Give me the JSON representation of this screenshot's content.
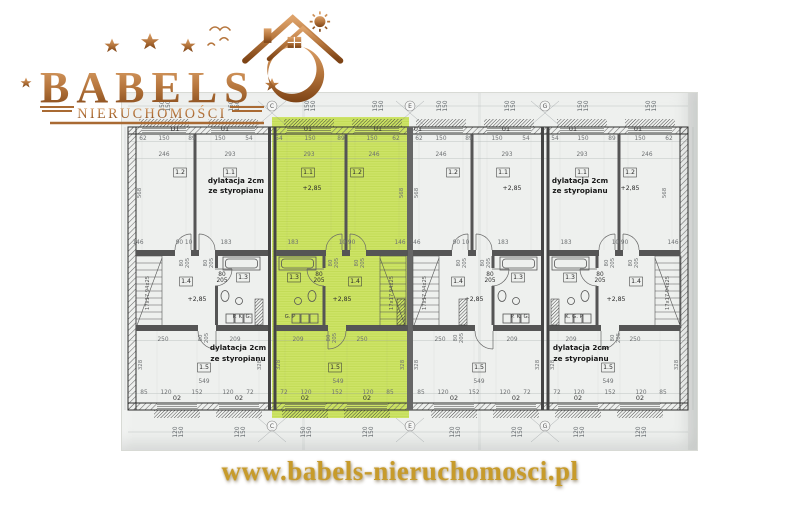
{
  "brand": {
    "name": "BABELS",
    "subtitle": "NIERUCHOMOŚCI"
  },
  "website": {
    "url": "www.babels-nieruchomosci.pl"
  },
  "colors": {
    "copper": "#b06c35",
    "copper_dark": "#7d4517",
    "copper_light": "#e0ab72",
    "gold": "#c79b2b",
    "highlight_green": "#cde367",
    "paper": "#eef0ee",
    "wall": "#4a4a4a"
  },
  "floorplan": {
    "description": "Row of four terraced-house segments, upper floor plan; second segment from left highlighted green",
    "annotations": {
      "expansion_joint_line1": "dylatacja 2cm",
      "expansion_joint_line2": "ze styropianu",
      "level_mark": "+2,85",
      "stairs_spec": "17x17.94x25"
    },
    "labels": [
      {
        "t": "150\n150",
        "x": 42,
        "y": 13,
        "c": "wd",
        "r": -90
      },
      {
        "t": "150\n150",
        "x": 111,
        "y": 13,
        "c": "wd",
        "r": -90
      },
      {
        "t": "150\n150",
        "x": 187,
        "y": 13,
        "c": "wd",
        "r": -90
      },
      {
        "t": "150\n150",
        "x": 255,
        "y": 13,
        "c": "wd",
        "r": -90
      },
      {
        "t": "150\n150",
        "x": 319,
        "y": 13,
        "c": "wd",
        "r": -90
      },
      {
        "t": "150\n150",
        "x": 387,
        "y": 13,
        "c": "wd",
        "r": -90
      },
      {
        "t": "150\n150",
        "x": 460,
        "y": 13,
        "c": "wd",
        "r": -90
      },
      {
        "t": "150\n150",
        "x": 528,
        "y": 13,
        "c": "wd",
        "r": -90
      },
      {
        "t": "C",
        "x": 150,
        "y": 15,
        "c": "ax"
      },
      {
        "t": "E",
        "x": 288,
        "y": 15,
        "c": "ax"
      },
      {
        "t": "G",
        "x": 423,
        "y": 15,
        "c": "ax"
      },
      {
        "t": "C",
        "x": 150,
        "y": 335,
        "c": "ax"
      },
      {
        "t": "E",
        "x": 288,
        "y": 335,
        "c": "ax"
      },
      {
        "t": "G",
        "x": 423,
        "y": 335,
        "c": "ax"
      },
      {
        "t": "D1",
        "x": 53,
        "y": 38,
        "c": "win"
      },
      {
        "t": "01",
        "x": 103,
        "y": 38,
        "c": "win"
      },
      {
        "t": "01",
        "x": 186,
        "y": 38,
        "c": "win"
      },
      {
        "t": "01",
        "x": 256,
        "y": 38,
        "c": "win"
      },
      {
        "t": "01",
        "x": 296,
        "y": 38,
        "c": "win"
      },
      {
        "t": "01",
        "x": 384,
        "y": 38,
        "c": "win"
      },
      {
        "t": "01",
        "x": 451,
        "y": 38,
        "c": "win"
      },
      {
        "t": "01",
        "x": 516,
        "y": 38,
        "c": "win"
      },
      {
        "t": "62",
        "x": 21,
        "y": 47,
        "c": "d"
      },
      {
        "t": "150",
        "x": 42,
        "y": 47,
        "c": "d"
      },
      {
        "t": "89",
        "x": 70,
        "y": 47,
        "c": "d"
      },
      {
        "t": "150",
        "x": 98,
        "y": 47,
        "c": "d"
      },
      {
        "t": "54",
        "x": 127,
        "y": 47,
        "c": "d"
      },
      {
        "t": "54",
        "x": 157,
        "y": 47,
        "c": "d"
      },
      {
        "t": "150",
        "x": 188,
        "y": 47,
        "c": "d"
      },
      {
        "t": "89",
        "x": 219,
        "y": 47,
        "c": "d"
      },
      {
        "t": "150",
        "x": 250,
        "y": 47,
        "c": "d"
      },
      {
        "t": "62",
        "x": 274,
        "y": 47,
        "c": "d"
      },
      {
        "t": "62",
        "x": 297,
        "y": 47,
        "c": "d"
      },
      {
        "t": "150",
        "x": 319,
        "y": 47,
        "c": "d"
      },
      {
        "t": "89",
        "x": 347,
        "y": 47,
        "c": "d"
      },
      {
        "t": "150",
        "x": 375,
        "y": 47,
        "c": "d"
      },
      {
        "t": "54",
        "x": 404,
        "y": 47,
        "c": "d"
      },
      {
        "t": "54",
        "x": 433,
        "y": 47,
        "c": "d"
      },
      {
        "t": "150",
        "x": 461,
        "y": 47,
        "c": "d"
      },
      {
        "t": "89",
        "x": 490,
        "y": 47,
        "c": "d"
      },
      {
        "t": "150",
        "x": 518,
        "y": 47,
        "c": "d"
      },
      {
        "t": "62",
        "x": 547,
        "y": 47,
        "c": "d"
      },
      {
        "t": "246",
        "x": 42,
        "y": 63,
        "c": "d"
      },
      {
        "t": "293",
        "x": 108,
        "y": 63,
        "c": "d"
      },
      {
        "t": "293",
        "x": 187,
        "y": 63,
        "c": "d"
      },
      {
        "t": "246",
        "x": 252,
        "y": 63,
        "c": "d"
      },
      {
        "t": "246",
        "x": 319,
        "y": 63,
        "c": "d"
      },
      {
        "t": "293",
        "x": 385,
        "y": 63,
        "c": "d"
      },
      {
        "t": "293",
        "x": 460,
        "y": 63,
        "c": "d"
      },
      {
        "t": "246",
        "x": 525,
        "y": 63,
        "c": "d"
      },
      {
        "t": "1.2",
        "x": 58,
        "y": 81,
        "c": "rl"
      },
      {
        "t": "1.1",
        "x": 108,
        "y": 81,
        "c": "rl"
      },
      {
        "t": "1.1",
        "x": 186,
        "y": 81,
        "c": "rl"
      },
      {
        "t": "1.2",
        "x": 235,
        "y": 81,
        "c": "rl"
      },
      {
        "t": "1.2",
        "x": 331,
        "y": 81,
        "c": "rl"
      },
      {
        "t": "1.1",
        "x": 381,
        "y": 81,
        "c": "rl"
      },
      {
        "t": "1.1",
        "x": 460,
        "y": 81,
        "c": "rl"
      },
      {
        "t": "1.2",
        "x": 508,
        "y": 81,
        "c": "rl"
      },
      {
        "t": "dylatacja 2cm",
        "x": 114,
        "y": 90,
        "c": "dy"
      },
      {
        "t": "ze styropianu",
        "x": 114,
        "y": 100,
        "c": "dy"
      },
      {
        "t": "dylatacja 2cm",
        "x": 458,
        "y": 90,
        "c": "dy"
      },
      {
        "t": "ze styropianu",
        "x": 458,
        "y": 100,
        "c": "dy"
      },
      {
        "t": "+2,85",
        "x": 190,
        "y": 97,
        "c": "lvl"
      },
      {
        "t": "+2,85",
        "x": 390,
        "y": 97,
        "c": "lvl"
      },
      {
        "t": "+2,85",
        "x": 508,
        "y": 97,
        "c": "lvl"
      },
      {
        "t": "568",
        "x": 19,
        "y": 100,
        "c": "dr",
        "r": -90
      },
      {
        "t": "568",
        "x": 281,
        "y": 100,
        "c": "dr",
        "r": -90
      },
      {
        "t": "568",
        "x": 296,
        "y": 100,
        "c": "dr",
        "r": -90
      },
      {
        "t": "568",
        "x": 544,
        "y": 100,
        "c": "dr",
        "r": -90
      },
      {
        "t": "146",
        "x": 16,
        "y": 151,
        "c": "d"
      },
      {
        "t": "90 10",
        "x": 62,
        "y": 151,
        "c": "d"
      },
      {
        "t": "183",
        "x": 104,
        "y": 151,
        "c": "d"
      },
      {
        "t": "183",
        "x": 171,
        "y": 151,
        "c": "d"
      },
      {
        "t": "10 90",
        "x": 225,
        "y": 151,
        "c": "d"
      },
      {
        "t": "146",
        "x": 278,
        "y": 151,
        "c": "d"
      },
      {
        "t": "146",
        "x": 293,
        "y": 151,
        "c": "d"
      },
      {
        "t": "90 10",
        "x": 339,
        "y": 151,
        "c": "d"
      },
      {
        "t": "183",
        "x": 381,
        "y": 151,
        "c": "d"
      },
      {
        "t": "183",
        "x": 444,
        "y": 151,
        "c": "d"
      },
      {
        "t": "10 90",
        "x": 498,
        "y": 151,
        "c": "d"
      },
      {
        "t": "146",
        "x": 551,
        "y": 151,
        "c": "d"
      },
      {
        "t": "80\n205",
        "x": 61,
        "y": 170,
        "c": "dr",
        "r": -90
      },
      {
        "t": "80\n205",
        "x": 85,
        "y": 170,
        "c": "dr",
        "r": -90
      },
      {
        "t": "80\n205",
        "x": 210,
        "y": 170,
        "c": "dr",
        "r": -90
      },
      {
        "t": "80\n205",
        "x": 236,
        "y": 170,
        "c": "dr",
        "r": -90
      },
      {
        "t": "80\n205",
        "x": 338,
        "y": 170,
        "c": "dr",
        "r": -90
      },
      {
        "t": "80\n205",
        "x": 362,
        "y": 170,
        "c": "dr",
        "r": -90
      },
      {
        "t": "80\n205",
        "x": 486,
        "y": 170,
        "c": "dr",
        "r": -90
      },
      {
        "t": "80\n205",
        "x": 510,
        "y": 170,
        "c": "dr",
        "r": -90
      },
      {
        "t": "1.4",
        "x": 64,
        "y": 190,
        "c": "rl"
      },
      {
        "t": "1.3",
        "x": 121,
        "y": 186,
        "c": "rl"
      },
      {
        "t": "1.3",
        "x": 172,
        "y": 186,
        "c": "rl"
      },
      {
        "t": "1.4",
        "x": 233,
        "y": 190,
        "c": "rl"
      },
      {
        "t": "1.4",
        "x": 336,
        "y": 190,
        "c": "rl"
      },
      {
        "t": "1.3",
        "x": 396,
        "y": 186,
        "c": "rl"
      },
      {
        "t": "1.3",
        "x": 448,
        "y": 186,
        "c": "rl"
      },
      {
        "t": "1.4",
        "x": 514,
        "y": 190,
        "c": "rl"
      },
      {
        "t": "80\n205",
        "x": 100,
        "y": 183,
        "c": "d205"
      },
      {
        "t": "80\n205",
        "x": 197,
        "y": 183,
        "c": "d205"
      },
      {
        "t": "80\n205",
        "x": 368,
        "y": 183,
        "c": "d205"
      },
      {
        "t": "80\n205",
        "x": 478,
        "y": 183,
        "c": "d205"
      },
      {
        "t": "17x17.94x25",
        "x": 27,
        "y": 200,
        "c": "st",
        "r": -90
      },
      {
        "t": "17x17.94x25",
        "x": 271,
        "y": 200,
        "c": "st",
        "r": -90
      },
      {
        "t": "17x17.94x25",
        "x": 304,
        "y": 200,
        "c": "st",
        "r": -90
      },
      {
        "t": "17x17.94x25",
        "x": 547,
        "y": 200,
        "c": "st",
        "r": -90
      },
      {
        "t": "+2,85",
        "x": 75,
        "y": 208,
        "c": "lvl"
      },
      {
        "t": "+2,85",
        "x": 220,
        "y": 208,
        "c": "lvl"
      },
      {
        "t": "+2,85",
        "x": 352,
        "y": 208,
        "c": "lvl"
      },
      {
        "t": "+2,85",
        "x": 494,
        "y": 208,
        "c": "lvl"
      },
      {
        "t": "P. K. G.",
        "x": 120,
        "y": 225,
        "c": "pkg"
      },
      {
        "t": "G. P",
        "x": 168,
        "y": 225,
        "c": "pkg"
      },
      {
        "t": "P. K. G.",
        "x": 398,
        "y": 225,
        "c": "pkg"
      },
      {
        "t": "K. G. P",
        "x": 452,
        "y": 225,
        "c": "pkg"
      },
      {
        "t": "80\n205",
        "x": 80,
        "y": 245,
        "c": "dr",
        "r": -90
      },
      {
        "t": "80\n205",
        "x": 208,
        "y": 245,
        "c": "dr",
        "r": -90
      },
      {
        "t": "80\n205",
        "x": 335,
        "y": 245,
        "c": "dr",
        "r": -90
      },
      {
        "t": "80\n205",
        "x": 492,
        "y": 245,
        "c": "dr",
        "r": -90
      },
      {
        "t": "250",
        "x": 41,
        "y": 248,
        "c": "d"
      },
      {
        "t": "209",
        "x": 113,
        "y": 248,
        "c": "d"
      },
      {
        "t": "209",
        "x": 176,
        "y": 248,
        "c": "d"
      },
      {
        "t": "250",
        "x": 240,
        "y": 248,
        "c": "d"
      },
      {
        "t": "250",
        "x": 318,
        "y": 248,
        "c": "d"
      },
      {
        "t": "209",
        "x": 390,
        "y": 248,
        "c": "d"
      },
      {
        "t": "209",
        "x": 449,
        "y": 248,
        "c": "d"
      },
      {
        "t": "250",
        "x": 513,
        "y": 248,
        "c": "d"
      },
      {
        "t": "dylatacja 2cm",
        "x": 116,
        "y": 257,
        "c": "dy"
      },
      {
        "t": "ze styropianu",
        "x": 116,
        "y": 268,
        "c": "dy"
      },
      {
        "t": "dylatacja 2cm",
        "x": 459,
        "y": 257,
        "c": "dy"
      },
      {
        "t": "ze styropianu",
        "x": 459,
        "y": 268,
        "c": "dy"
      },
      {
        "t": "328",
        "x": 20,
        "y": 272,
        "c": "dr",
        "r": -90
      },
      {
        "t": "328",
        "x": 139,
        "y": 272,
        "c": "dr",
        "r": -90
      },
      {
        "t": "328",
        "x": 158,
        "y": 272,
        "c": "dr",
        "r": -90
      },
      {
        "t": "328",
        "x": 282,
        "y": 272,
        "c": "dr",
        "r": -90
      },
      {
        "t": "328",
        "x": 296,
        "y": 272,
        "c": "dr",
        "r": -90
      },
      {
        "t": "328",
        "x": 417,
        "y": 272,
        "c": "dr",
        "r": -90
      },
      {
        "t": "328",
        "x": 432,
        "y": 272,
        "c": "dr",
        "r": -90
      },
      {
        "t": "328",
        "x": 556,
        "y": 272,
        "c": "dr",
        "r": -90
      },
      {
        "t": "1.5",
        "x": 82,
        "y": 276,
        "c": "rl"
      },
      {
        "t": "1.5",
        "x": 213,
        "y": 276,
        "c": "rl"
      },
      {
        "t": "1.5",
        "x": 357,
        "y": 276,
        "c": "rl"
      },
      {
        "t": "1.5",
        "x": 486,
        "y": 276,
        "c": "rl"
      },
      {
        "t": "549",
        "x": 82,
        "y": 290,
        "c": "d"
      },
      {
        "t": "549",
        "x": 216,
        "y": 290,
        "c": "d"
      },
      {
        "t": "549",
        "x": 357,
        "y": 290,
        "c": "d"
      },
      {
        "t": "549",
        "x": 486,
        "y": 290,
        "c": "d"
      },
      {
        "t": "85",
        "x": 22,
        "y": 301,
        "c": "d"
      },
      {
        "t": "120",
        "x": 44,
        "y": 301,
        "c": "d"
      },
      {
        "t": "152",
        "x": 75,
        "y": 301,
        "c": "d"
      },
      {
        "t": "120",
        "x": 106,
        "y": 301,
        "c": "d"
      },
      {
        "t": "72",
        "x": 128,
        "y": 301,
        "c": "d"
      },
      {
        "t": "72",
        "x": 162,
        "y": 301,
        "c": "d"
      },
      {
        "t": "120",
        "x": 184,
        "y": 301,
        "c": "d"
      },
      {
        "t": "152",
        "x": 215,
        "y": 301,
        "c": "d"
      },
      {
        "t": "120",
        "x": 246,
        "y": 301,
        "c": "d"
      },
      {
        "t": "85",
        "x": 268,
        "y": 301,
        "c": "d"
      },
      {
        "t": "85",
        "x": 299,
        "y": 301,
        "c": "d"
      },
      {
        "t": "120",
        "x": 321,
        "y": 301,
        "c": "d"
      },
      {
        "t": "152",
        "x": 352,
        "y": 301,
        "c": "d"
      },
      {
        "t": "120",
        "x": 383,
        "y": 301,
        "c": "d"
      },
      {
        "t": "72",
        "x": 405,
        "y": 301,
        "c": "d"
      },
      {
        "t": "72",
        "x": 435,
        "y": 301,
        "c": "d"
      },
      {
        "t": "120",
        "x": 457,
        "y": 301,
        "c": "d"
      },
      {
        "t": "152",
        "x": 488,
        "y": 301,
        "c": "d"
      },
      {
        "t": "120",
        "x": 519,
        "y": 301,
        "c": "d"
      },
      {
        "t": "85",
        "x": 541,
        "y": 301,
        "c": "d"
      },
      {
        "t": "02",
        "x": 55,
        "y": 307,
        "c": "win"
      },
      {
        "t": "02",
        "x": 117,
        "y": 307,
        "c": "win"
      },
      {
        "t": "02",
        "x": 183,
        "y": 307,
        "c": "win"
      },
      {
        "t": "02",
        "x": 245,
        "y": 307,
        "c": "win"
      },
      {
        "t": "02",
        "x": 332,
        "y": 307,
        "c": "win"
      },
      {
        "t": "02",
        "x": 394,
        "y": 307,
        "c": "win"
      },
      {
        "t": "02",
        "x": 456,
        "y": 307,
        "c": "win"
      },
      {
        "t": "02",
        "x": 518,
        "y": 307,
        "c": "win"
      },
      {
        "t": "120\n150",
        "x": 55,
        "y": 339,
        "c": "wd",
        "r": -90
      },
      {
        "t": "120\n150",
        "x": 117,
        "y": 339,
        "c": "wd",
        "r": -90
      },
      {
        "t": "150\n150",
        "x": 183,
        "y": 339,
        "c": "wd",
        "r": -90
      },
      {
        "t": "120\n150",
        "x": 245,
        "y": 339,
        "c": "wd",
        "r": -90
      },
      {
        "t": "120\n150",
        "x": 332,
        "y": 339,
        "c": "wd",
        "r": -90
      },
      {
        "t": "120\n150",
        "x": 394,
        "y": 339,
        "c": "wd",
        "r": -90
      },
      {
        "t": "120\n150",
        "x": 456,
        "y": 339,
        "c": "wd",
        "r": -90
      },
      {
        "t": "120\n150",
        "x": 518,
        "y": 339,
        "c": "wd",
        "r": -90
      }
    ]
  }
}
